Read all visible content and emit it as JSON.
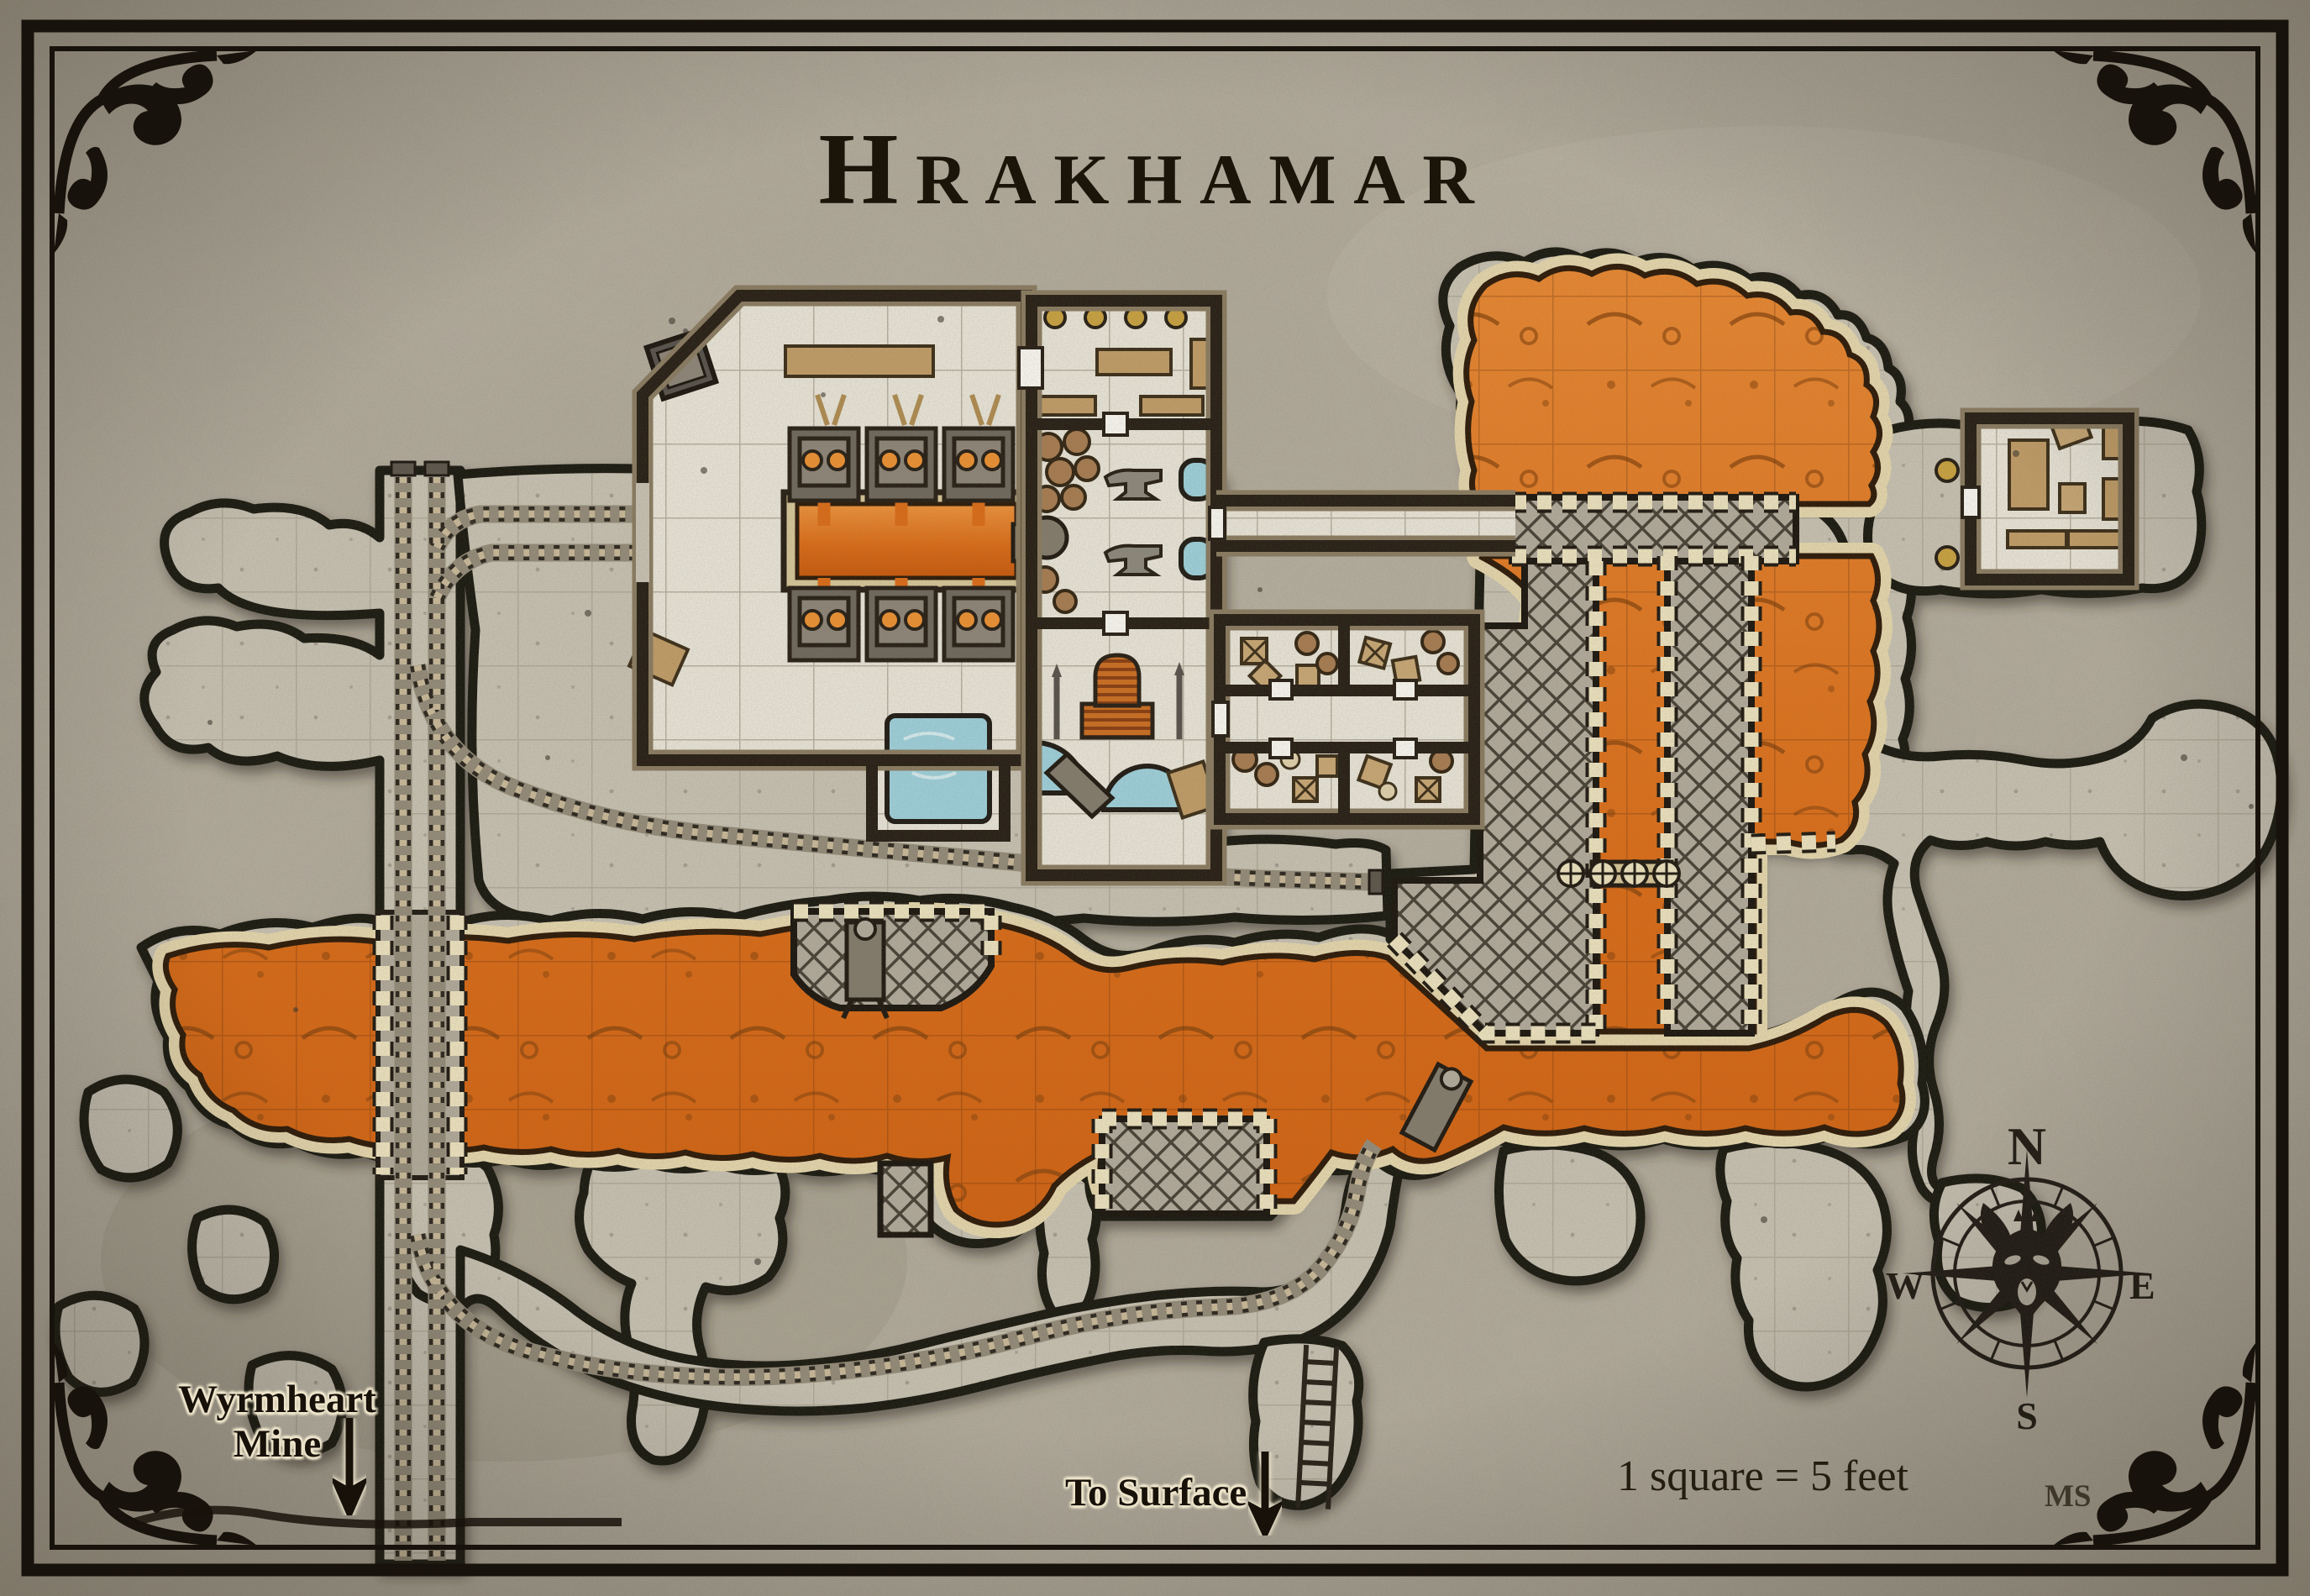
{
  "map": {
    "title": "Hrakhamar",
    "scale_note": "1 square = 5 feet",
    "artist_initials": "MS",
    "labels": {
      "wyrmheart_line1": "Wyrmheart",
      "wyrmheart_line2": "Mine",
      "to_surface": "To Surface"
    },
    "compass": {
      "north": "N",
      "east": "E",
      "south": "S",
      "west": "W"
    },
    "palette": {
      "parchment": "#b5ae9f",
      "cave_floor": "#c9c3b4",
      "room_floor": "#ebe7da",
      "lava": "#dd6b14",
      "lava_bank": "#e7d9ae",
      "water": "#9ed2de",
      "ink": "#17120b",
      "wood": "#c29d66",
      "crenellation": "#efe5c1"
    }
  }
}
